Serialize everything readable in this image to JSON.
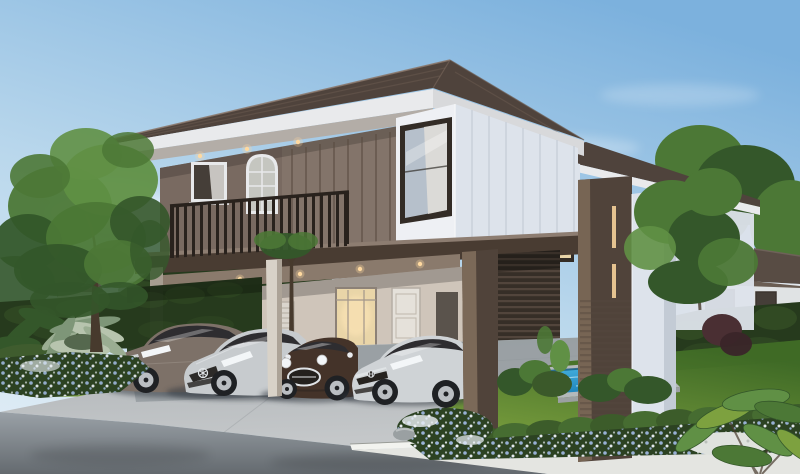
{
  "meta": {
    "title": "Two-storey modern house rendering with carport, four cars and plunge pool",
    "width": 800,
    "height": 474
  },
  "scene": {
    "description": "Daytime photorealistic exterior rendering: a modern two-storey detached house with dark taupe timber battens and white siding, deep roof eaves, a first-floor balcony with dark metal railing, an open ground-floor carport sheltering four cars, a small blue plunge pool, clipped hedges, blue flower beds, a concrete driveway meeting an asphalt street and white kerb, with neighbouring houses and trees behind.",
    "objects": {
      "sky": "Clear pale-blue morning sky with soft clouds",
      "clouds": "Soft white clouds",
      "neighbour_left": "Neighbouring house glimpsed behind the left hedge",
      "neighbour_right": "Neighbouring two-storey house beyond the right hedge",
      "trees_right": "Garden trees behind and beside the house",
      "hedge_left": "Tall clipped boundary hedge on the left",
      "hedge_right": "Tall clipped boundary hedge on the right",
      "house": "Main two-storey modern house",
      "roof": "Low-pitch hipped roof with dark tiles and white fascia",
      "rear_wing": "Rear wing of the house with warm-lit tall window",
      "upper_floor": "Upper floor with taupe batten walls and windows",
      "balcony": "Cantilevered balcony with dark vertical-bar railing",
      "window_corner": "Corner window with white curtain on the white gable box",
      "carport": "Open double-height carport under the upper floor",
      "ground_floor": "Ground-floor entry wall with louvered and glazed doors",
      "portal": "Dark timber portal frame and slatted screen",
      "cars": "Four cars parked side by side in the carport",
      "car_accord": "Bronze-grey Honda Accord style sedan",
      "car_mercedes": "Silver Mercedes-Benz style compact sedan with star grille",
      "car_mini": "Dark-brown MINI style hatchback with chrome grille",
      "car_civic": "Silver Honda Civic style sedan with H badge",
      "column": "Slim light concrete carport column",
      "pool": "Rectangular blue plunge pool with grey coping",
      "lawn": "Manicured lawn beside the pool",
      "gravel_path": "White gravel strip crossing the lawn",
      "hedgerow": "Low clipped hedge row along the garden front",
      "flower_bed": "Bed of blue and white flowers along the kerb",
      "street": "Grey asphalt street in the foreground",
      "sidewalk": "White concrete footpath and kerb",
      "driveway": "Light concrete driveway apron",
      "foreground_plants": "Silvery tropical foliage and blue flowers at left",
      "big_tree": "Large leafy garden tree on the left",
      "leaves_right": "Arching tropical leaves in the right foreground"
    }
  },
  "palette": {
    "sky_top": "#7cb1dd",
    "sky_mid": "#b9d7ec",
    "sky_low": "#ddebf5",
    "cloud": "#ffffff",
    "roof_dark": "#4f433c",
    "roof_tile": "#6a5a4f",
    "fascia": "#e9eaec",
    "soffit": "#b3ada7",
    "wall_taupe": "#83746a",
    "wall_recess": "#796a61",
    "batten": "#5a4c42",
    "rail_dark": "#29221d",
    "slab": "#493c32",
    "slab_top": "#8d7d71",
    "siding_white": "#eef0f4",
    "siding_shade": "#dde3eb",
    "seam": "#c5ccd7",
    "frame_dark": "#332c26",
    "frame_white": "#e8e9eb",
    "glass_dark": "#453e38",
    "glass_cool": "#b6c0cb",
    "curtain": "#dedcd8",
    "glass_warm": "#e9d5a8",
    "light_warm": "#ffd9a0",
    "post_lit": "#7b6958",
    "post_dark": "#50433a",
    "slat": "#55483e",
    "slat_bg": "#362e27",
    "gf_wall": "#cfc5ba",
    "door_white": "#e5e1da",
    "louver": "#dad5cd",
    "column_lit": "#d8d2c8",
    "column_shade": "#a79d91",
    "hedge_dark": "#263a1d",
    "hedge_lit": "#3b592a",
    "tree_mid": "#4c7836",
    "tree_light": "#609045",
    "tree_dark": "#34572a",
    "trunk": "#473a2d",
    "lawn_hi": "#7da13f",
    "lawn_mid": "#5a8530",
    "lawn_dark": "#3f6a26",
    "pool_hi": "#4ab6e3",
    "pool_deep": "#1f84bb",
    "pool_edge": "#155a7f",
    "coping": "#b4b9bb",
    "flower_blue": "#9db5dc",
    "flower_pale": "#edf1f7",
    "bed_dark": "#2c4222",
    "gravel": "#dfe2de",
    "rock": "#9aa0a2",
    "drive_hi": "#c4c7c9",
    "drive_mid": "#adb2b5",
    "drive_shadow": "#8e959a",
    "street_hi": "#9aa1a7",
    "street_dark": "#646a6f",
    "sidewalk": "#e4e5e1",
    "curb": "#f2f3ef",
    "bgh_wall": "#e0e3e4",
    "bgh_roof": "#584c44",
    "car1": "#7d7168",
    "car2": "#c7cbce",
    "car3": "#443329",
    "car4": "#cfd3d6",
    "car_glass": "#2e2d30",
    "wheel": "#1f2124",
    "alloy": "#babec2",
    "chrome": "#e0e4e7",
    "lamp": "#f3f6f8",
    "shadow": "#333940"
  }
}
